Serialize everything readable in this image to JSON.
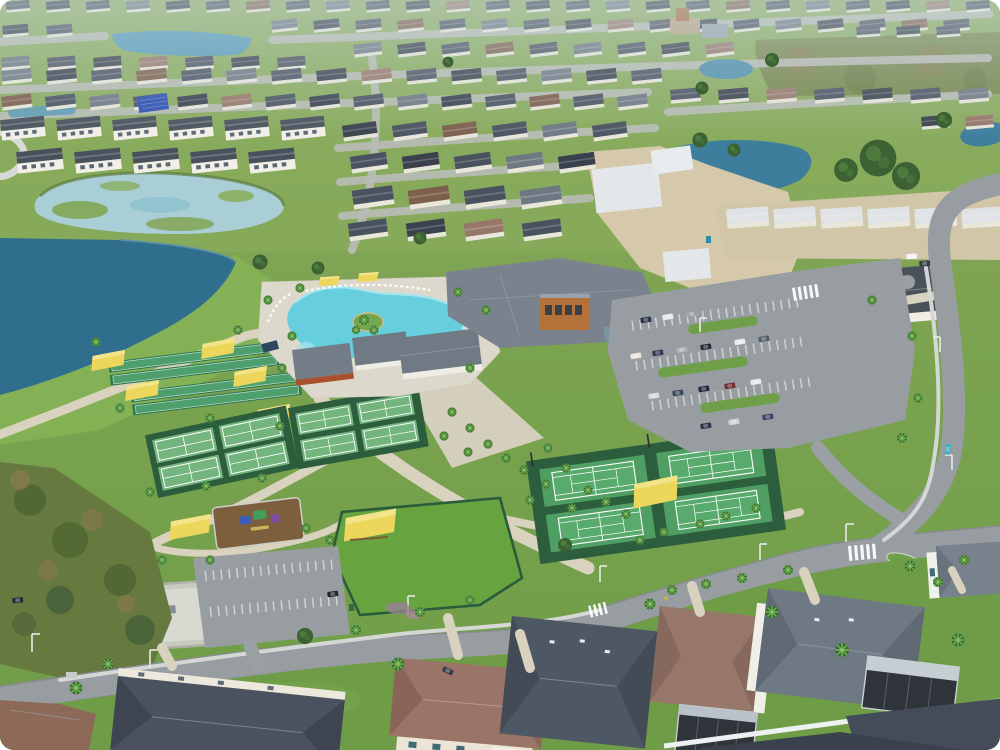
{
  "image": {
    "kind": "aerial photograph",
    "subject": "master-planned residential community amenity campus",
    "view": "oblique aerial"
  },
  "palette": {
    "grass": "#7ba350",
    "lake": "#2f6f8d",
    "pond": "#a9ced5",
    "pool": "#66cedd",
    "lawn": "#67a440",
    "court_green": "#4f9e63",
    "court_surround": "#2c5e3e",
    "canopy_yellow": "#ecd65c",
    "sand": "#d6c9ab",
    "road": "#989da1",
    "deck": "#dcd8cc",
    "roof_slate": "#4a5260",
    "roof_brown": "#9a7466",
    "roof_new_white": "#dfe3e6",
    "clubhouse_wood": "#b5713a"
  },
  "features": [
    {
      "id": "retention-lake",
      "label": "large retention lake"
    },
    {
      "id": "algae-pond",
      "label": "pond with algae patches"
    },
    {
      "id": "lagoon-pool",
      "label": "resort-style lagoon pool with palm island"
    },
    {
      "id": "clubhouse",
      "label": "amenity clubhouse with orange wood tower"
    },
    {
      "id": "bocce-courts",
      "label": "bocce lanes with yellow shade canopies"
    },
    {
      "id": "pickleball-courts",
      "label": "two banks of pickleball courts"
    },
    {
      "id": "tennis-courts",
      "label": "four tennis courts with central yellow gazebo"
    },
    {
      "id": "event-lawn",
      "label": "fenced event lawn with yellow pavilion"
    },
    {
      "id": "playground",
      "label": "playground with yellow shade sail"
    },
    {
      "id": "utility-yard",
      "label": "walled utility yard"
    },
    {
      "id": "parking",
      "label": "parking lots with striped stalls and cars"
    },
    {
      "id": "roads",
      "label": "curving community roads with crosswalks and street lights"
    },
    {
      "id": "new-construction",
      "label": "homes under construction on sand lots"
    },
    {
      "id": "neighborhood",
      "label": "dense rows of single-family homes"
    },
    {
      "id": "solar-roof",
      "label": "rooftop solar array"
    }
  ],
  "counts": {
    "tennis_courts": 4,
    "pickleball_courts": 8,
    "bocce_lanes": 4,
    "yellow_canopies": 9,
    "pools": 1
  }
}
